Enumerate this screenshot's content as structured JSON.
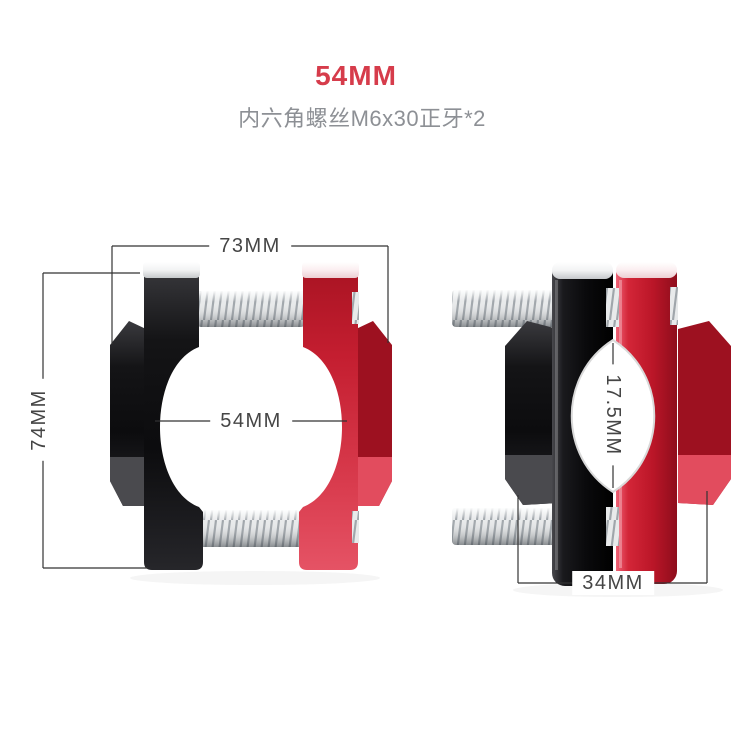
{
  "header": {
    "title": "54MM",
    "subtitle": "内六角螺丝M6x30正牙*2"
  },
  "front_view": {
    "dimensions": {
      "overall_width": "73MM",
      "overall_height": "74MM",
      "bore_diameter": "54MM"
    }
  },
  "side_view": {
    "dimensions": {
      "side_opening": "17.5MM",
      "body_depth": "34MM"
    }
  },
  "colors": {
    "title_red": "#d63c4b",
    "subtitle_gray": "#8d9095",
    "dimension_text": "#454545",
    "dimension_line": "#333333",
    "clamp_black": "#131315",
    "clamp_red": "#c81c2f",
    "screw_chrome": "#e8eaeb",
    "background": "#ffffff"
  }
}
